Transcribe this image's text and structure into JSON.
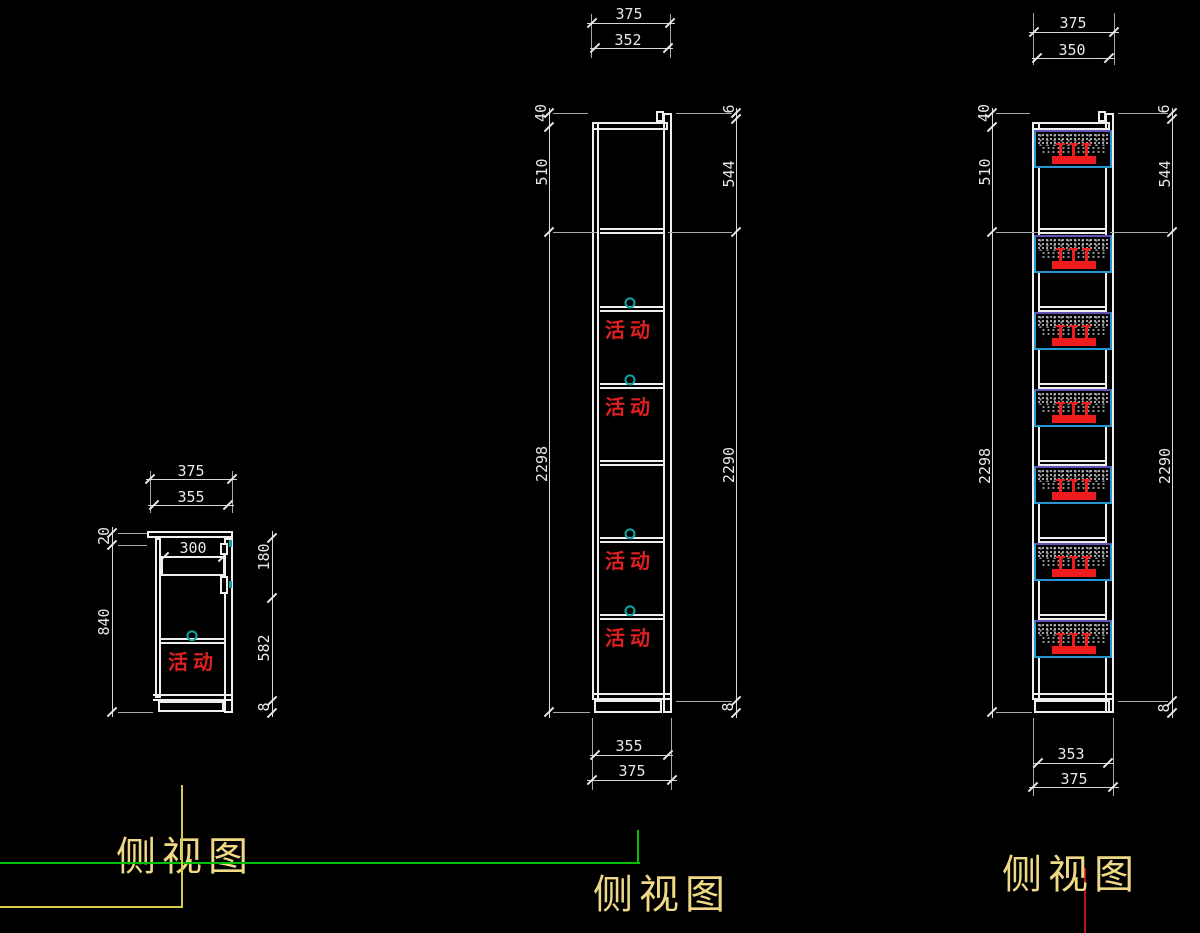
{
  "drawing": {
    "type": "cad-side-elevations",
    "background": "#000000"
  },
  "views": {
    "left": {
      "title": "侧视图",
      "shelf_label": "活动",
      "dims": {
        "top_outer": "375",
        "top_inner": "355",
        "drawer": "300",
        "left_top": "20",
        "left_height": "840",
        "right_upper": "180",
        "right_lower": "582",
        "base": "8"
      }
    },
    "middle": {
      "title": "侧视图",
      "shelf_labels": [
        "活动",
        "活动",
        "活动",
        "活动"
      ],
      "dims": {
        "top_outer": "375",
        "top_inner": "352",
        "bottom_inner": "355",
        "bottom_outer": "375",
        "left_top": "40",
        "left_upper": "510",
        "left_total": "2298",
        "right_top": "6",
        "right_upper": "544",
        "right_total": "2290",
        "base": "8"
      }
    },
    "right": {
      "title": "侧视图",
      "dims": {
        "top_outer": "375",
        "top_inner": "350",
        "bottom_inner": "353",
        "bottom_outer": "375",
        "left_top": "40",
        "left_upper": "510",
        "left_total": "2298",
        "right_top": "6",
        "right_upper": "544",
        "right_total": "2290",
        "base": "8"
      }
    }
  },
  "colors": {
    "background": "#000000",
    "geometry_line": "#efefef",
    "dimension_text": "#e8e8e8",
    "movable_text": "#e02020",
    "shelf_pin_marker": "#12a3a3",
    "basket_outline": "#2596d1",
    "basket_top_edge": "#6550b5",
    "basket_speckle": "#aaaaaa",
    "bracket_red": "#ee1c1c",
    "title_text": "#f0d985",
    "layout_green": "#00c000",
    "layout_yellow": "#d8cc44",
    "layout_red": "#c01010"
  }
}
